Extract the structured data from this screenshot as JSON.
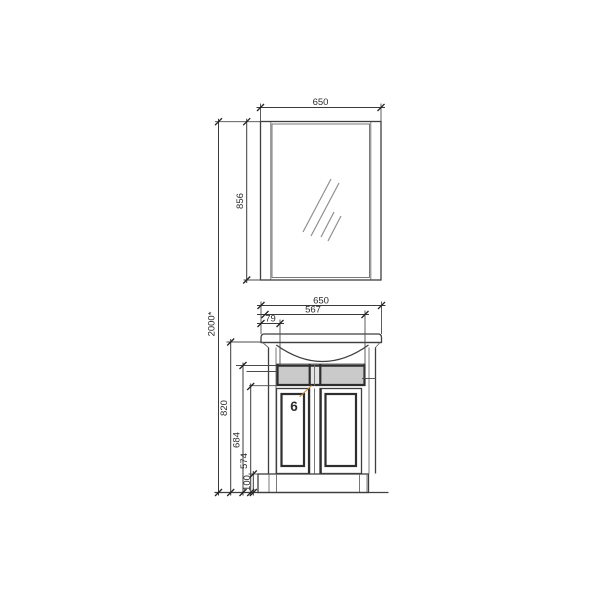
{
  "drawing": {
    "callout": {
      "number": "6"
    },
    "dimensions": {
      "mirror_width": "650",
      "mirror_height": "856",
      "total_height": "2000*",
      "vanity_width": "650",
      "basin_width": "567",
      "side_offset": "79",
      "worktop_height": "820",
      "band_height": "684",
      "door_height": "574",
      "plinth_height": "100"
    },
    "colors": {
      "line": "#3f3f3f",
      "accent": "#e8821c",
      "band_fill": "#cacaca",
      "band_center_fill": "#e4e4e4",
      "glass_fill": "#ffffff"
    }
  }
}
